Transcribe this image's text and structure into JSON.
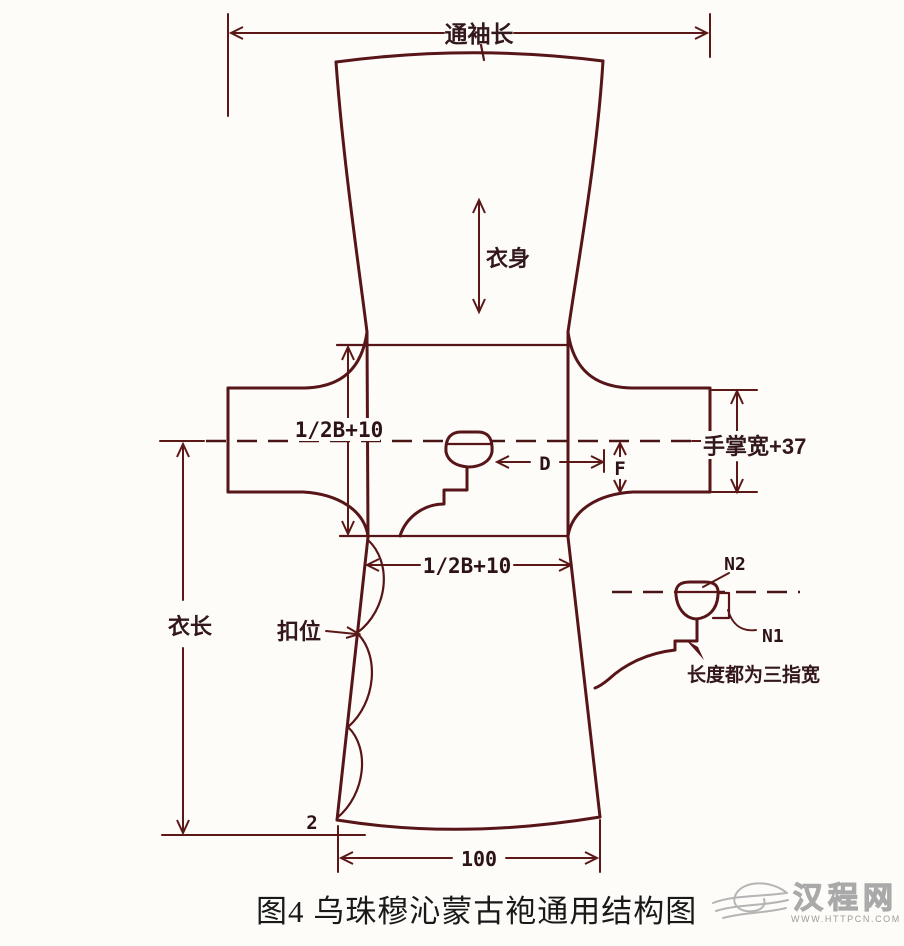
{
  "figure": {
    "caption": "图4  乌珠穆沁蒙古袍通用结构图",
    "labels": {
      "total_sleeve_length": "通袖长",
      "garment_body": "衣身",
      "chest_to_waist": "1/2B+10",
      "waist_width": "1/2B+10",
      "cuff_width": "手掌宽+37",
      "d_dim": "D",
      "f_dim": "F",
      "garment_length": "衣长",
      "button_position": "扣位",
      "n2": "N2",
      "n1": "N1",
      "detail_note": "长度都为三指宽",
      "hem_rise": "2",
      "hem_width": "100"
    },
    "colors": {
      "line": "#571518",
      "label_text": "#33171a",
      "caption_text": "#191919",
      "watermark": "#a9a9a9",
      "background": "#fdfcf9"
    }
  },
  "watermark": {
    "site_name": "汉程网",
    "site_url": "WWW.HTTPCN.COM"
  }
}
